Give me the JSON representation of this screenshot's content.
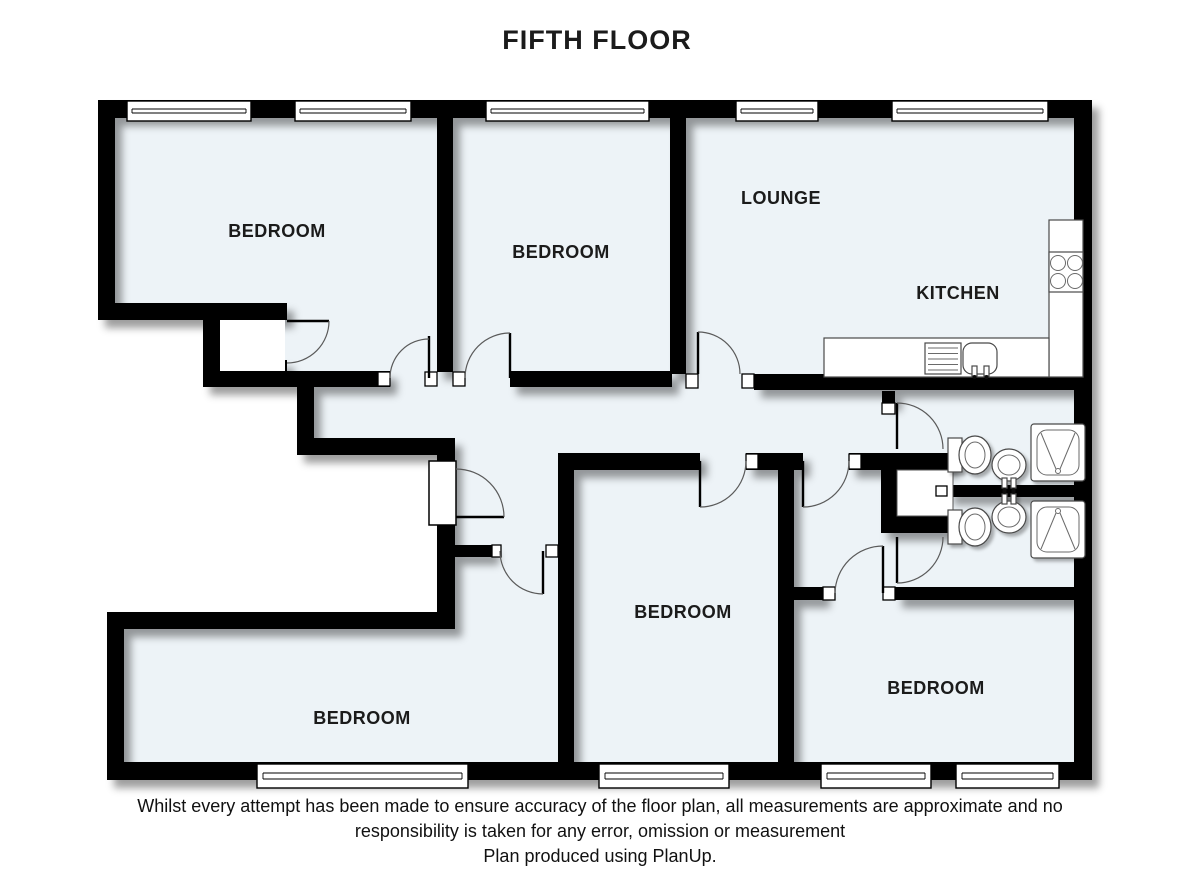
{
  "title": "FIFTH FLOOR",
  "colors": {
    "floor": "#edf3f7",
    "wall": "#000000",
    "background": "#ffffff"
  },
  "rooms": [
    {
      "id": "bedroom-top-left",
      "label": "BEDROOM"
    },
    {
      "id": "bedroom-top-middle",
      "label": "BEDROOM"
    },
    {
      "id": "lounge",
      "label": "LOUNGE"
    },
    {
      "id": "kitchen",
      "label": "KITCHEN"
    },
    {
      "id": "bedroom-bottom-middle",
      "label": "BEDROOM"
    },
    {
      "id": "bedroom-bottom-right",
      "label": "BEDROOM"
    },
    {
      "id": "bedroom-bottom-left",
      "label": "BEDROOM"
    }
  ],
  "disclaimer": {
    "line1": "Whilst every attempt has been made to ensure accuracy of the floor plan, all measurements are approximate and no",
    "line2": "responsibility is taken for any error, omission or measurement",
    "line3": "Plan produced using PlanUp."
  }
}
